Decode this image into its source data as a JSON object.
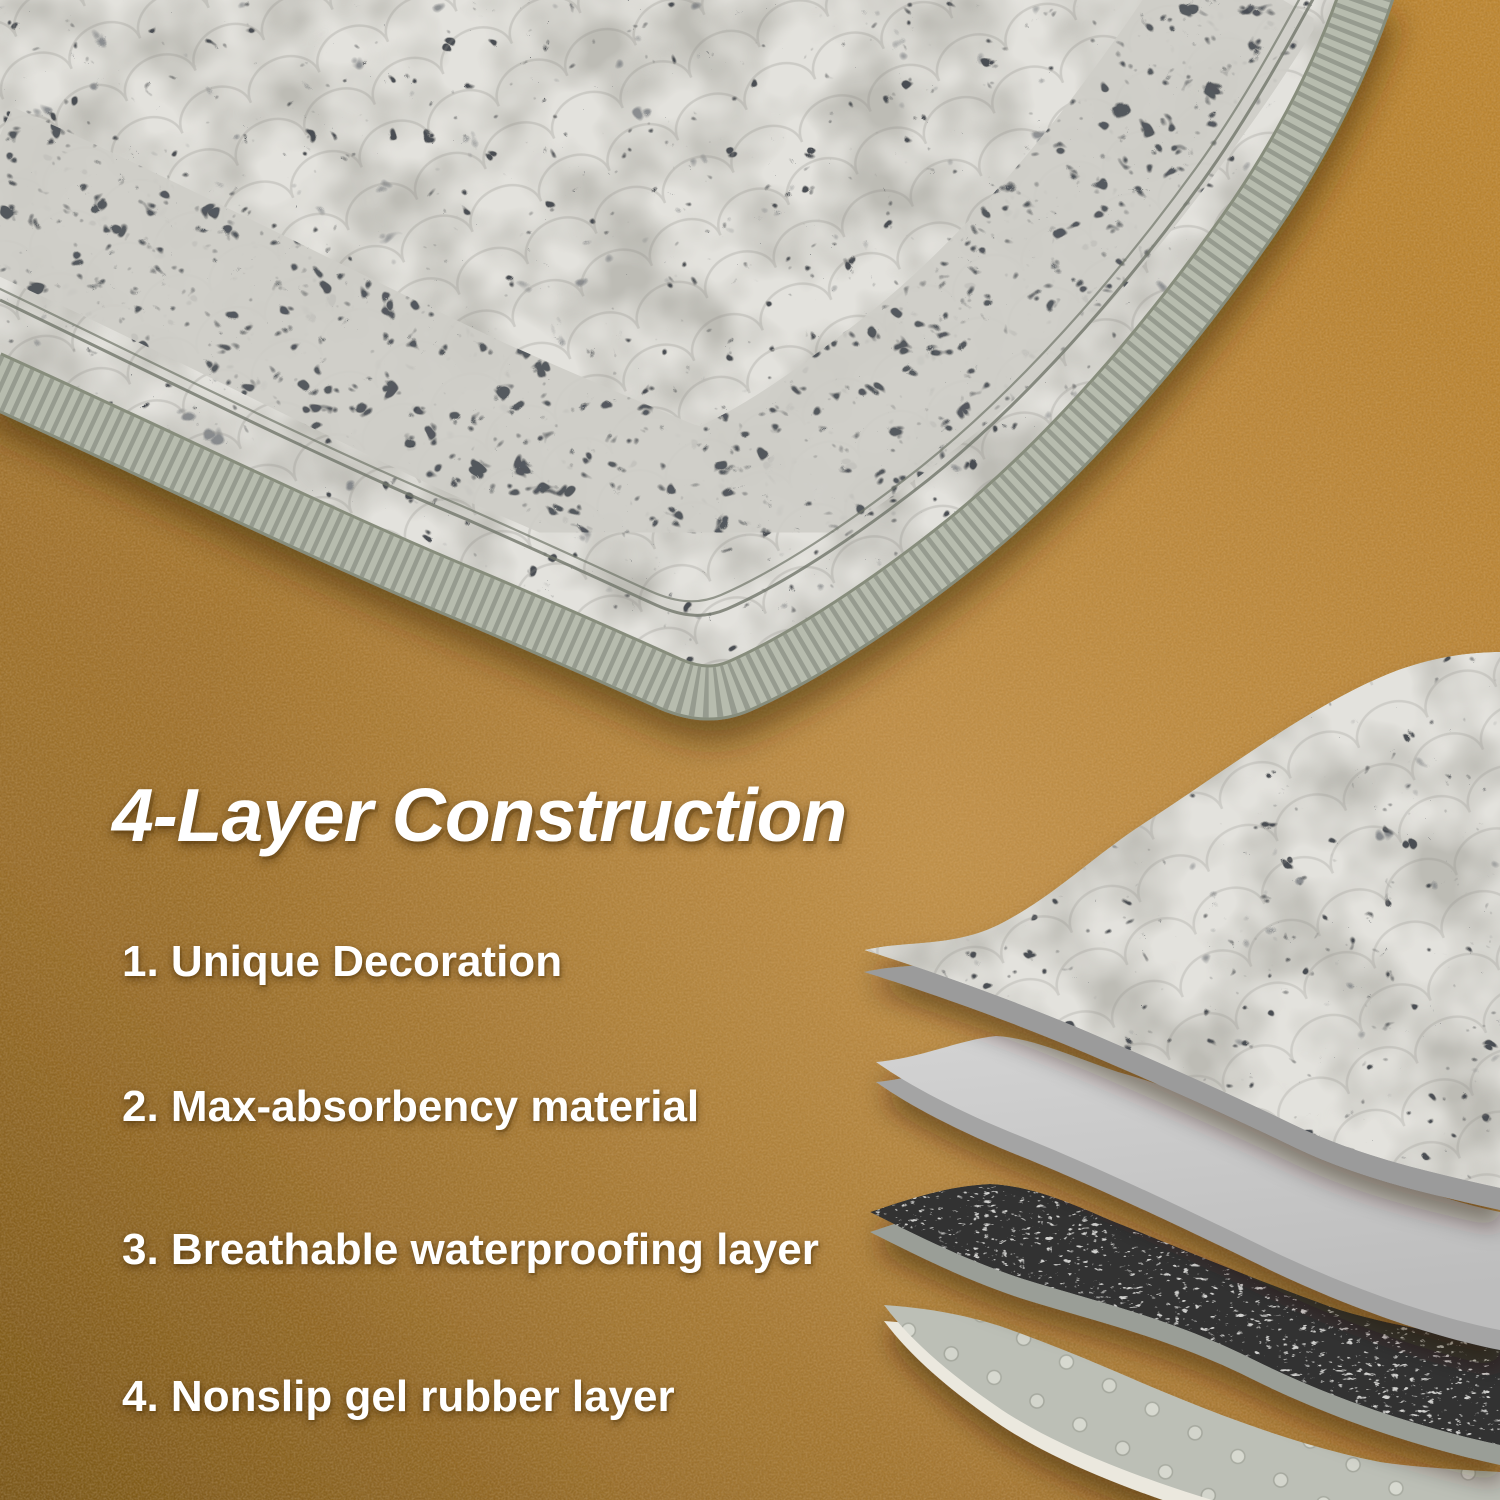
{
  "headline": {
    "title": "4-Layer Construction"
  },
  "features": {
    "items": [
      "1. Unique Decoration",
      "2. Max-absorbency material",
      "3. Breathable waterproofing layer",
      "4. Nonslip gel rubber layer"
    ]
  },
  "colors": {
    "floor_base": "#b5823c",
    "floor_dark": "#7d5a20",
    "floor_light": "#c9995a",
    "rug_fabric": "#e3e2dd",
    "rug_pattern_dark": "#4a4e53",
    "rug_binding_edge": "#b7bcae",
    "layer1_underside": "#9b9b9b",
    "layer2_gray": "#c8c8c8",
    "layer3_mesh_dark": "#313131",
    "layer4_gel_gray": "#bcbfb6",
    "layer4_bottom_band": "#ebe8de",
    "text": "#ffffff"
  }
}
